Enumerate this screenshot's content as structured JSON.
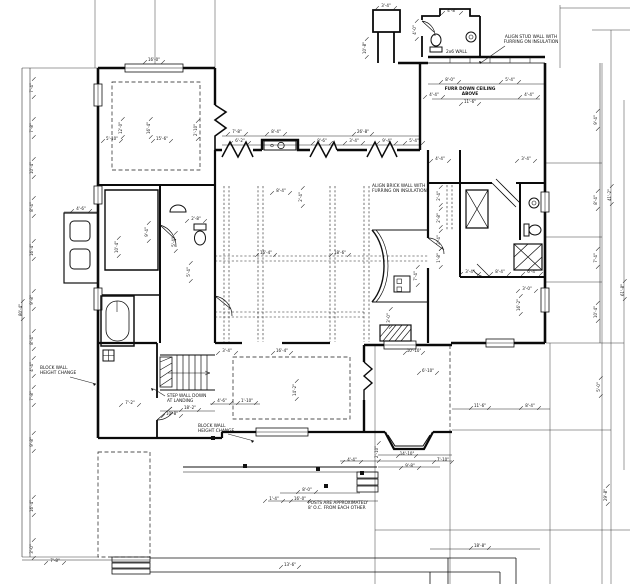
{
  "drawing": {
    "kind": "architectural-floor-plan",
    "background": "#ffffff",
    "line_color": "#1a1a1a"
  },
  "annotations": [
    {
      "id": "align-stud-wall-note",
      "lines": [
        "ALIGN STUD WALL WITH",
        "FURRING ON INSULATION"
      ],
      "x": 531,
      "y": 38,
      "anchor": "middle",
      "bold": false,
      "leader": [
        505,
        46,
        482,
        62
      ]
    },
    {
      "id": "wall-type-note",
      "lines": [
        "2x6 WALL"
      ],
      "x": 446,
      "y": 53,
      "anchor": "start",
      "bold": false
    },
    {
      "id": "furr-ceiling-note",
      "lines": [
        "FURR DOWN CEILING",
        "ABOVE"
      ],
      "x": 470,
      "y": 90,
      "anchor": "middle",
      "bold": true
    },
    {
      "id": "align-brick-wall-note",
      "lines": [
        "ALIGN BRICK WALL WITH",
        "FURRING ON INSULATION"
      ],
      "x": 372,
      "y": 187,
      "anchor": "start",
      "bold": false
    },
    {
      "id": "block-wall-height-note-1",
      "lines": [
        "BLOCK WALL",
        "HEIGHT CHANGE"
      ],
      "x": 40,
      "y": 369,
      "anchor": "start",
      "bold": false,
      "leader": [
        70,
        377,
        96,
        384
      ]
    },
    {
      "id": "step-wall-note",
      "lines": [
        "STEP WALL DOWN",
        "AT LANDING"
      ],
      "x": 167,
      "y": 397,
      "anchor": "start",
      "bold": false,
      "leader": [
        165,
        396,
        154,
        389
      ]
    },
    {
      "id": "block-wall-height-note-2",
      "lines": [
        "BLOCK WALL",
        "HEIGHT CHANGE"
      ],
      "x": 198,
      "y": 427,
      "anchor": "start",
      "bold": false,
      "leader": [
        228,
        434,
        254,
        441
      ]
    },
    {
      "id": "posts-note",
      "lines": [
        "POSTS ARE APPROXIMATELY",
        "8' O.C. FROM EACH OTHER"
      ],
      "x": 308,
      "y": 504,
      "anchor": "start",
      "bold": false
    }
  ],
  "dims": [
    {
      "t": "7'-4\"",
      "x": 33,
      "y": 88,
      "r": 1
    },
    {
      "t": "7'-8\"",
      "x": 33,
      "y": 128,
      "r": 1
    },
    {
      "t": "10'-4\"",
      "x": 33,
      "y": 168,
      "r": 1
    },
    {
      "t": "8'-4\"",
      "x": 33,
      "y": 207,
      "r": 1
    },
    {
      "t": "16'-4\"",
      "x": 33,
      "y": 250,
      "r": 1
    },
    {
      "t": "9'-8\"",
      "x": 33,
      "y": 300,
      "r": 1
    },
    {
      "t": "8'-4\"",
      "x": 33,
      "y": 340,
      "r": 1
    },
    {
      "t": "4'-4\"",
      "x": 33,
      "y": 367,
      "r": 1
    },
    {
      "t": "7'-8\"",
      "x": 33,
      "y": 396,
      "r": 1
    },
    {
      "t": "9'-8\"",
      "x": 33,
      "y": 442,
      "r": 1
    },
    {
      "t": "16'-4\"",
      "x": 33,
      "y": 506,
      "r": 1
    },
    {
      "t": "3'-0\"",
      "x": 33,
      "y": 549,
      "r": 1
    },
    {
      "t": "80'-4\"",
      "x": 22,
      "y": 310,
      "r": 1
    },
    {
      "t": "16'-0\"",
      "x": 154,
      "y": 61,
      "r": 0
    },
    {
      "t": "2'-10\"",
      "x": 197,
      "y": 130,
      "r": 1
    },
    {
      "t": "12'-0\"",
      "x": 122,
      "y": 128,
      "r": 1
    },
    {
      "t": "16'-4\"",
      "x": 150,
      "y": 128,
      "r": 1
    },
    {
      "t": "5'-10\"",
      "x": 112,
      "y": 140,
      "r": 0
    },
    {
      "t": "15'-6\"",
      "x": 162,
      "y": 140,
      "r": 0
    },
    {
      "t": "3'-4\"",
      "x": 386,
      "y": 7,
      "r": 0
    },
    {
      "t": "4'-8\"",
      "x": 452,
      "y": 12,
      "r": 0
    },
    {
      "t": "10'-8\"",
      "x": 366,
      "y": 48,
      "r": 1
    },
    {
      "t": "4'-0\"",
      "x": 416,
      "y": 30,
      "r": 1
    },
    {
      "t": "8'-0\"",
      "x": 450,
      "y": 81,
      "r": 0
    },
    {
      "t": "5'-4\"",
      "x": 510,
      "y": 81,
      "r": 0
    },
    {
      "t": "4'-4\"",
      "x": 434,
      "y": 96,
      "r": 0
    },
    {
      "t": "4'-4\"",
      "x": 529,
      "y": 96,
      "r": 0
    },
    {
      "t": "11'-6\"",
      "x": 470,
      "y": 103,
      "r": 0
    },
    {
      "t": "7'-8\"",
      "x": 237,
      "y": 133,
      "r": 0
    },
    {
      "t": "8'-4\"",
      "x": 276,
      "y": 133,
      "r": 0
    },
    {
      "t": "26'-8\"",
      "x": 363,
      "y": 133,
      "r": 0
    },
    {
      "t": "6'-2\"",
      "x": 240,
      "y": 142,
      "r": 0
    },
    {
      "t": "8'-6\"",
      "x": 322,
      "y": 142,
      "r": 0
    },
    {
      "t": "3'-4\"",
      "x": 354,
      "y": 142,
      "r": 0
    },
    {
      "t": "9'-4\"",
      "x": 387,
      "y": 142,
      "r": 0
    },
    {
      "t": "5'-4\"",
      "x": 414,
      "y": 142,
      "r": 0
    },
    {
      "t": "8'-4\"",
      "x": 281,
      "y": 192,
      "r": 0
    },
    {
      "t": "2'-4\"",
      "x": 302,
      "y": 197,
      "r": 1
    },
    {
      "t": "9'-4\"",
      "x": 148,
      "y": 232,
      "r": 1
    },
    {
      "t": "5'-4\"",
      "x": 175,
      "y": 242,
      "r": 1
    },
    {
      "t": "4'-6\"",
      "x": 81,
      "y": 210,
      "r": 0
    },
    {
      "t": "10'-4\"",
      "x": 118,
      "y": 247,
      "r": 1
    },
    {
      "t": "2'-8\"",
      "x": 196,
      "y": 220,
      "r": 0
    },
    {
      "t": "5'-4\"",
      "x": 190,
      "y": 272,
      "r": 1
    },
    {
      "t": "4'-6\"",
      "x": 222,
      "y": 402,
      "r": 0
    },
    {
      "t": "1'-10\"",
      "x": 247,
      "y": 402,
      "r": 0
    },
    {
      "t": "18'-2\"",
      "x": 190,
      "y": 409,
      "r": 0
    },
    {
      "t": "7'-2\"",
      "x": 130,
      "y": 404,
      "r": 0
    },
    {
      "t": "10'-8\"",
      "x": 172,
      "y": 415,
      "r": 0
    },
    {
      "t": "7'-4\"",
      "x": 417,
      "y": 276,
      "r": 1
    },
    {
      "t": "3'-0\"",
      "x": 390,
      "y": 318,
      "r": 1
    },
    {
      "t": "4'-4\"",
      "x": 440,
      "y": 160,
      "r": 0
    },
    {
      "t": "3'-4\"",
      "x": 526,
      "y": 160,
      "r": 0
    },
    {
      "t": "2'-4\"",
      "x": 440,
      "y": 196,
      "r": 1
    },
    {
      "t": "2'-8\"",
      "x": 440,
      "y": 218,
      "r": 1
    },
    {
      "t": "2'-4\"",
      "x": 440,
      "y": 240,
      "r": 1
    },
    {
      "t": "1'-8\"",
      "x": 440,
      "y": 258,
      "r": 1
    },
    {
      "t": "3'-4\"",
      "x": 470,
      "y": 273,
      "r": 0
    },
    {
      "t": "8'-4\"",
      "x": 500,
      "y": 273,
      "r": 0
    },
    {
      "t": "6'-4\"",
      "x": 532,
      "y": 273,
      "r": 0
    },
    {
      "t": "3'-0\"",
      "x": 527,
      "y": 290,
      "r": 0
    },
    {
      "t": "16'-2\"",
      "x": 520,
      "y": 305,
      "r": 1
    },
    {
      "t": "9'-4\"",
      "x": 597,
      "y": 120,
      "r": 1
    },
    {
      "t": "8'-4\"",
      "x": 597,
      "y": 200,
      "r": 1
    },
    {
      "t": "7'-4\"",
      "x": 597,
      "y": 258,
      "r": 1
    },
    {
      "t": "10'-4\"",
      "x": 597,
      "y": 312,
      "r": 1
    },
    {
      "t": "41'-2\"",
      "x": 611,
      "y": 195,
      "r": 1
    },
    {
      "t": "61'-8\"",
      "x": 624,
      "y": 290,
      "r": 1
    },
    {
      "t": "29'-8\"",
      "x": 607,
      "y": 495,
      "r": 1
    },
    {
      "t": "5'-0\"",
      "x": 600,
      "y": 387,
      "r": 1
    },
    {
      "t": "6'-10\"",
      "x": 428,
      "y": 372,
      "r": 0
    },
    {
      "t": "10'-10\"",
      "x": 414,
      "y": 352,
      "r": 0
    },
    {
      "t": "16'-4\"",
      "x": 282,
      "y": 352,
      "r": 0
    },
    {
      "t": "3'-4\"",
      "x": 227,
      "y": 352,
      "r": 0
    },
    {
      "t": "14'-2\"",
      "x": 296,
      "y": 390,
      "r": 1
    },
    {
      "t": "14'-10\"",
      "x": 407,
      "y": 455,
      "r": 0
    },
    {
      "t": "4'-4\"",
      "x": 352,
      "y": 461,
      "r": 0
    },
    {
      "t": "9'-8\"",
      "x": 410,
      "y": 467,
      "r": 0
    },
    {
      "t": "7'-10\"",
      "x": 443,
      "y": 461,
      "r": 0
    },
    {
      "t": "2'-10\"",
      "x": 378,
      "y": 452,
      "r": 1
    },
    {
      "t": "11'-6\"",
      "x": 480,
      "y": 407,
      "r": 0
    },
    {
      "t": "8'-4\"",
      "x": 530,
      "y": 407,
      "r": 0
    },
    {
      "t": "16'-4\"",
      "x": 266,
      "y": 254,
      "r": 0
    },
    {
      "t": "18'-6\"",
      "x": 340,
      "y": 254,
      "r": 0
    },
    {
      "t": "8'-0\"",
      "x": 307,
      "y": 491,
      "r": 0
    },
    {
      "t": "1'-4\"",
      "x": 274,
      "y": 500,
      "r": 0
    },
    {
      "t": "16'-0\"",
      "x": 300,
      "y": 500,
      "r": 0
    },
    {
      "t": "18'-8\"",
      "x": 480,
      "y": 547,
      "r": 0
    },
    {
      "t": "13'-6\"",
      "x": 290,
      "y": 566,
      "r": 0
    },
    {
      "t": "7'-8\"",
      "x": 55,
      "y": 562,
      "r": 0
    }
  ],
  "posts": [
    {
      "x": 213,
      "y": 438
    },
    {
      "x": 245,
      "y": 466
    },
    {
      "x": 318,
      "y": 469
    },
    {
      "x": 326,
      "y": 486
    },
    {
      "x": 362,
      "y": 473
    }
  ]
}
